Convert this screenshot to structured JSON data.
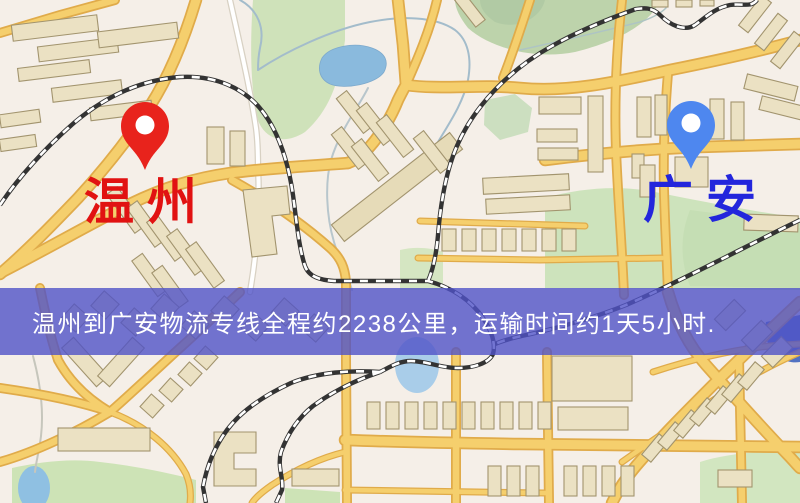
{
  "window": {
    "width": 800,
    "height": 503,
    "kind": "logistics-route-map"
  },
  "map": {
    "origin_marker": {
      "label": "温州",
      "pin_color": "#e8231c",
      "label_color": "#e11212"
    },
    "destination_marker": {
      "label": "广安",
      "pin_color": "#4e87ef",
      "label_color": "#2326dc"
    },
    "info_banner": {
      "text": "温州到广安物流专线全程约2238公里，运输时间约1天5小时.",
      "bg_color": "rgba(80,83,199,0.8)",
      "text_color": "#ffffff"
    },
    "palette": {
      "land": "#f5efe8",
      "park_green": "#c9dfb3",
      "water_blue": "#8abadd",
      "road_yellow": "#f5cf6d",
      "railway_dark": "#333333"
    }
  }
}
